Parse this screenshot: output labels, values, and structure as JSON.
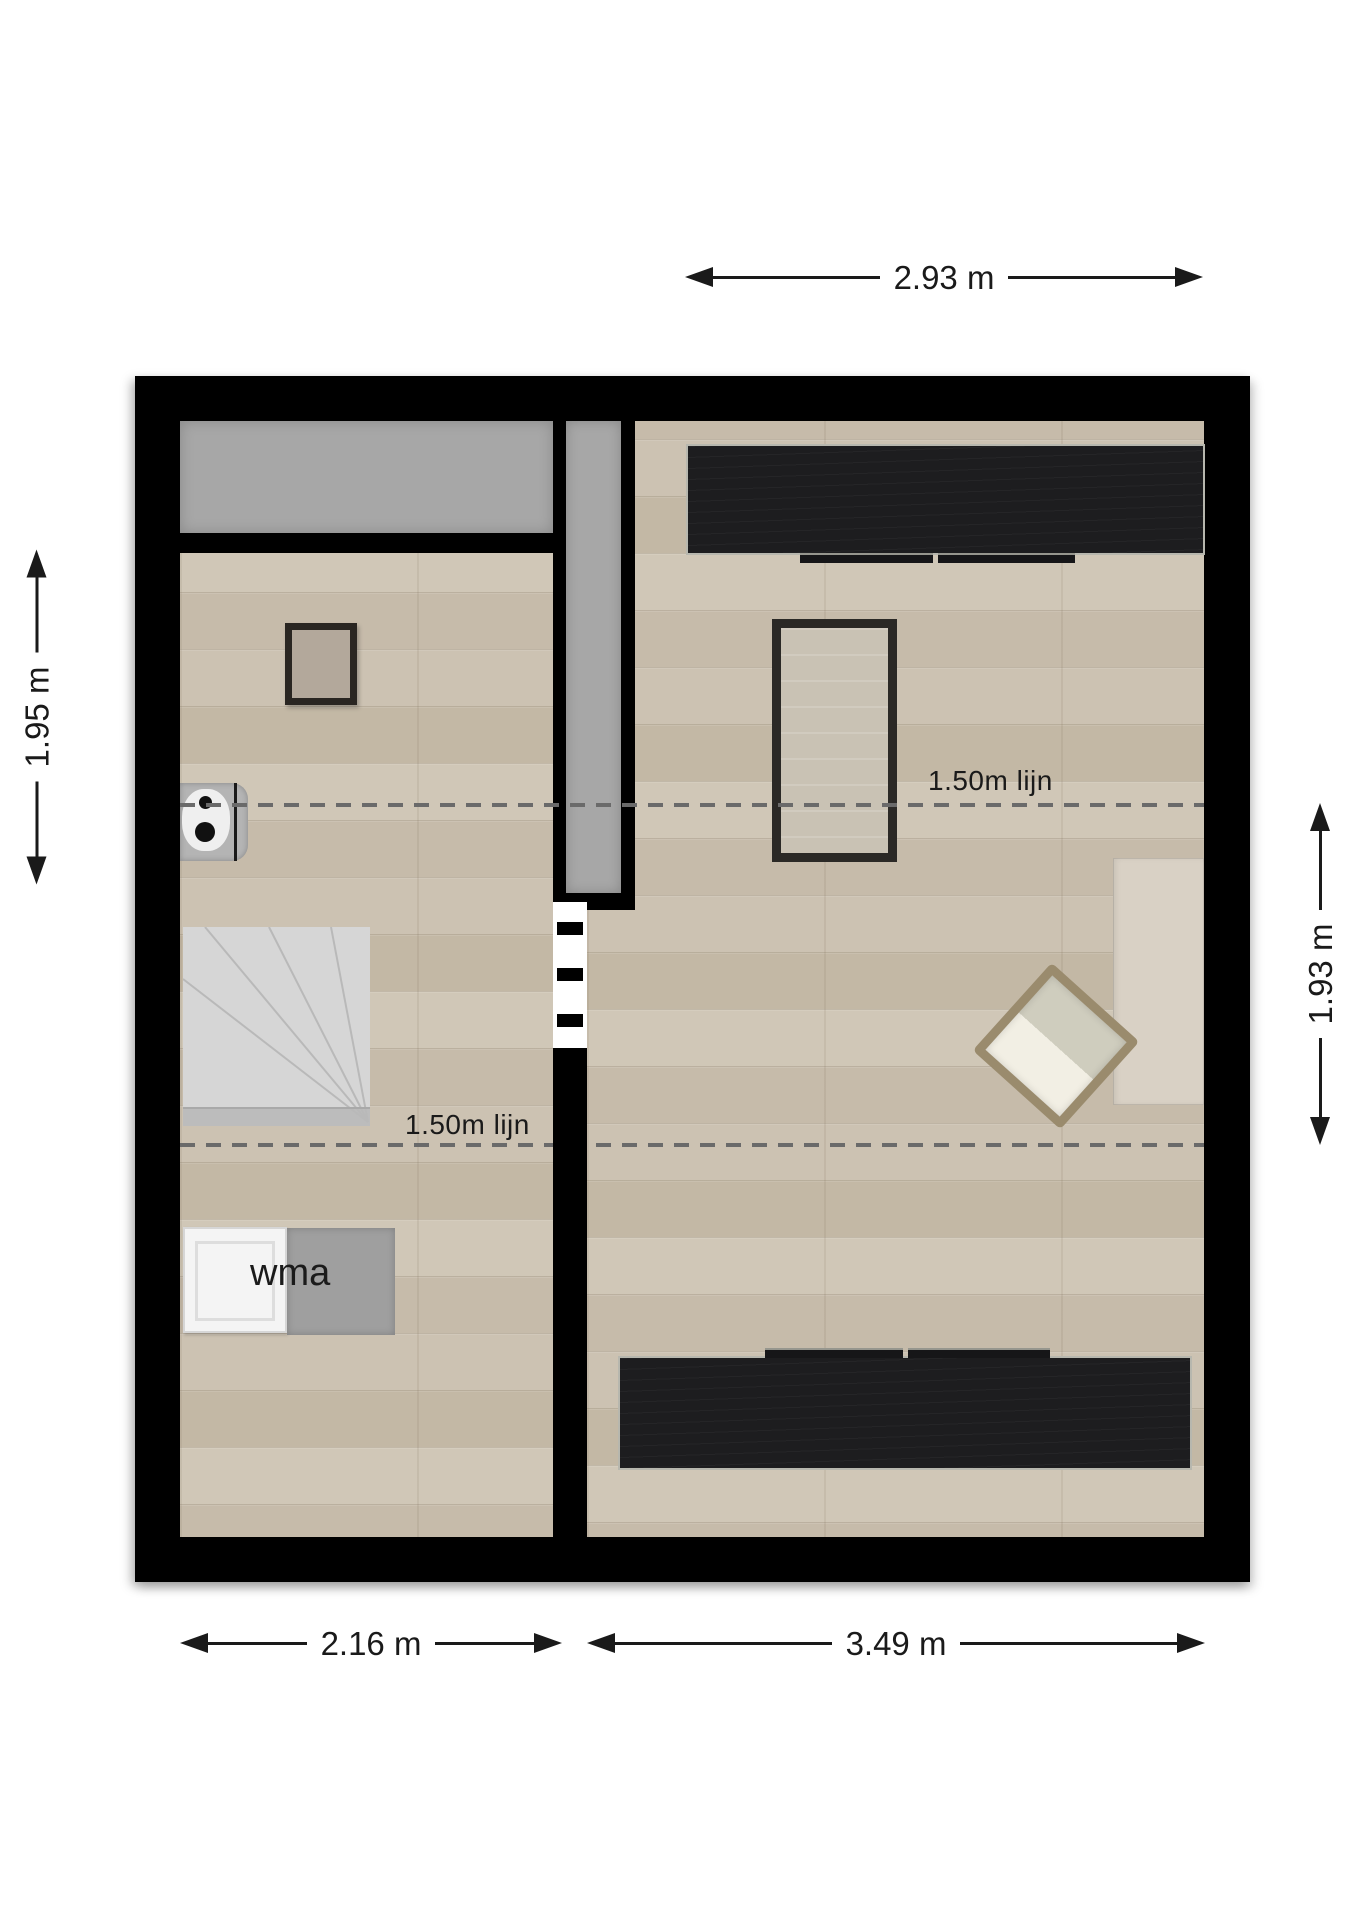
{
  "plan": {
    "type": "attic floor plan",
    "dim_top": "2.93 m",
    "dim_left": "1.95 m",
    "dim_right": "1.93 m",
    "dim_bottom_left": "2.16 m",
    "dim_bottom_right": "3.49 m",
    "height_line_label_right": "1.50m lijn",
    "height_line_label_left": "1.50m lijn",
    "washing_machine_label": "wma"
  },
  "colors": {
    "wall": "#000000",
    "floor_base": "#cbc1b1",
    "low_headroom": "#a7a7a7",
    "wardrobe": "#1d1d1f",
    "wardrobe_trim": "#b7b7ae",
    "rug_fill": "#c9c2b4",
    "rug_border": "#2b2926",
    "bed": "#d9d1c5",
    "chair_frame": "#9a8b6d",
    "chair_cushion": "#cfcdbe",
    "chair_seat": "#f2efe4",
    "stairs_fill": "#d6d6d6",
    "stairs_line": "#b9b9b9",
    "dashed_line": "#6a6a6a",
    "dim_color": "#1a1a1a",
    "label_color": "#1a1a1a",
    "door_gap": "#ffffff",
    "toilet_body": "#b4b4b4",
    "appliance_white": "#f4f4f4",
    "appliance_gray": "#9f9f9f"
  }
}
